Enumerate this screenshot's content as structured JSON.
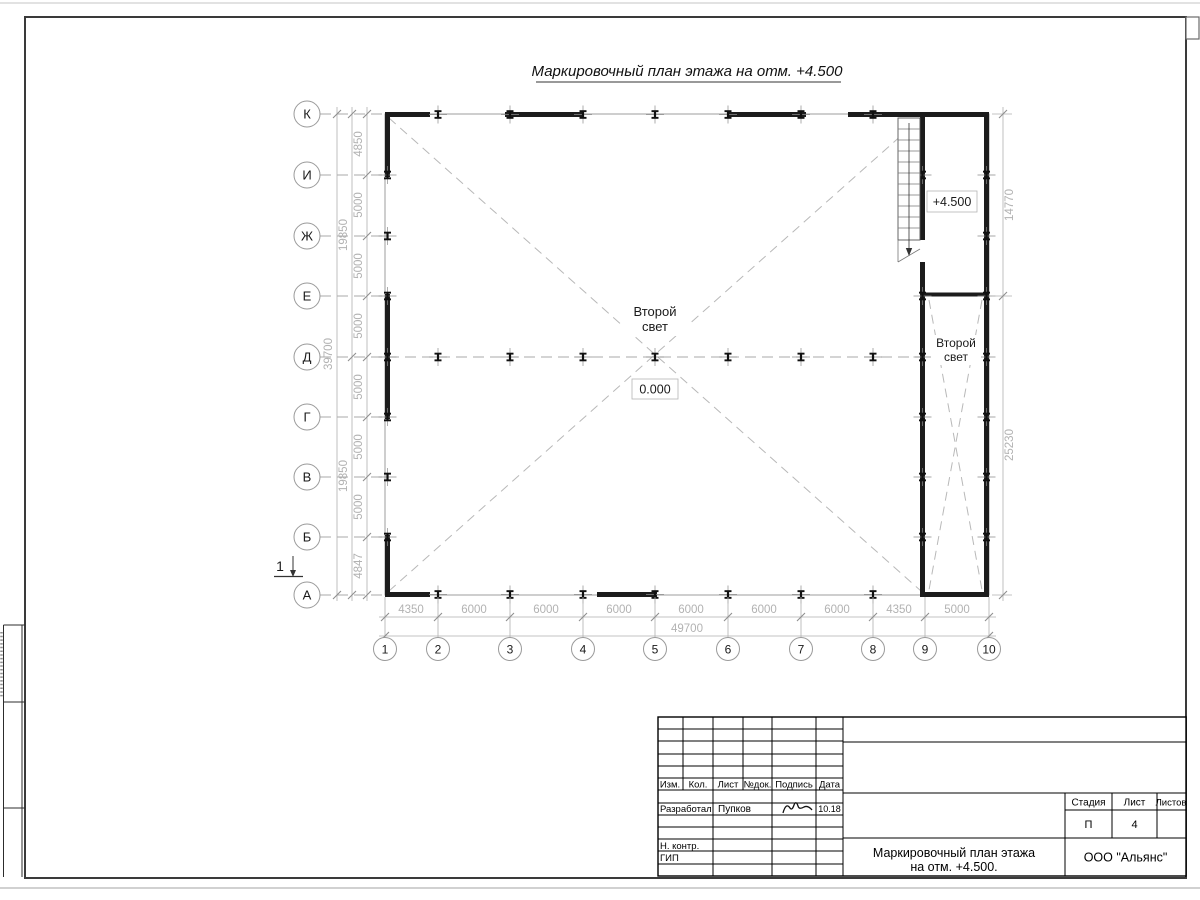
{
  "drawing_title": "Маркировочный план этажа на отм. +4.500",
  "axes": {
    "left": [
      "К",
      "И",
      "Ж",
      "Е",
      "Д",
      "Г",
      "В",
      "Б",
      "А"
    ],
    "bottom": [
      "1",
      "2",
      "3",
      "4",
      "5",
      "6",
      "7",
      "8",
      "9",
      "10"
    ]
  },
  "dims": {
    "left_segments": [
      "4850",
      "5000",
      "5000",
      "5000",
      "5000",
      "5000",
      "5000",
      "4847"
    ],
    "left_groups": [
      "19850",
      "19850"
    ],
    "left_total": "39700",
    "bottom_segments": [
      "4350",
      "6000",
      "6000",
      "6000",
      "6000",
      "6000",
      "6000",
      "4350",
      "5000"
    ],
    "bottom_total": "49700",
    "right_upper": "14770",
    "right_lower": "25230"
  },
  "labels": {
    "second_light_line1": "Второй",
    "second_light_line2": "свет",
    "level_zero": "0.000",
    "level_plus": "+4.500",
    "section_number": "1"
  },
  "titleblock": {
    "col_izm": "Изм.",
    "col_kol": "Кол.",
    "col_list": "Лист",
    "col_ndok": "№док.",
    "col_podpis": "Подпись",
    "col_data": "Дата",
    "row_razrabotal": "Разработал",
    "surname": "Пупков",
    "date": "10.18",
    "row_nkontr": "Н. контр.",
    "row_gip": "ГИП",
    "stage_label": "Стадия",
    "sheet_label": "Лист",
    "sheets_label": "Листов",
    "stage_value": "П",
    "sheet_value": "4",
    "doc_title_line1": "Маркировочный план этажа",
    "doc_title_line2": "на отм. +4.500.",
    "company": "ООО \"Альянс\""
  }
}
